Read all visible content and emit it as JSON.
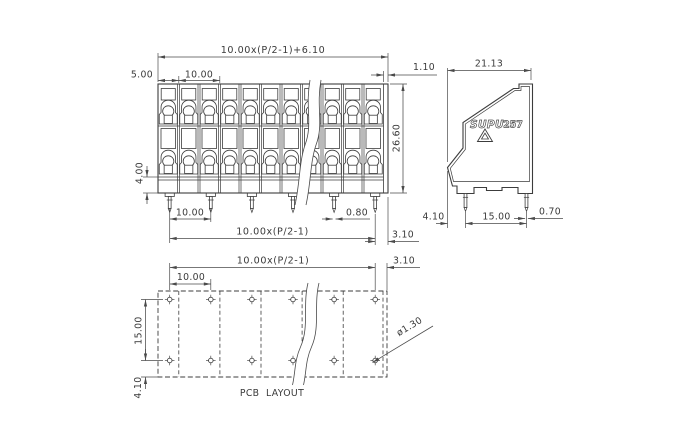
{
  "colors": {
    "background": "#ffffff",
    "outline": "#3c3c3c",
    "dimension": "#4a4a4a",
    "text": "#3a3a3a"
  },
  "front_view": {
    "columns": 11,
    "pins": 6,
    "clamp_rows": 2,
    "dims": {
      "total_width": "10.00x(P/2-1)+6.10",
      "edge_offset": "5.00",
      "pitch_top": "10.00",
      "lead_offset": "1.10",
      "height": "26.60",
      "skirt_height": "4.00",
      "pin_pitch": "10.00",
      "pin_width": "0.80",
      "pin_span": "10.00x(P/2-1)",
      "pin_edge": "3.10"
    }
  },
  "side_view": {
    "logo": "SUPU",
    "model": "257",
    "dims": {
      "depth": "21.13",
      "front_offset": "4.10",
      "pin_row_spacing": "15.00",
      "pin_width": "0.70"
    }
  },
  "pcb_layout": {
    "label": "PCB  LAYOUT",
    "hole_rows": 2,
    "holes_per_row": 6,
    "dims": {
      "span": "10.00x(P/2-1)",
      "edge": "3.10",
      "pitch": "10.00",
      "row_spacing": "15.00",
      "edge_bottom": "4.10",
      "hole_diameter": "ø1.30"
    }
  }
}
